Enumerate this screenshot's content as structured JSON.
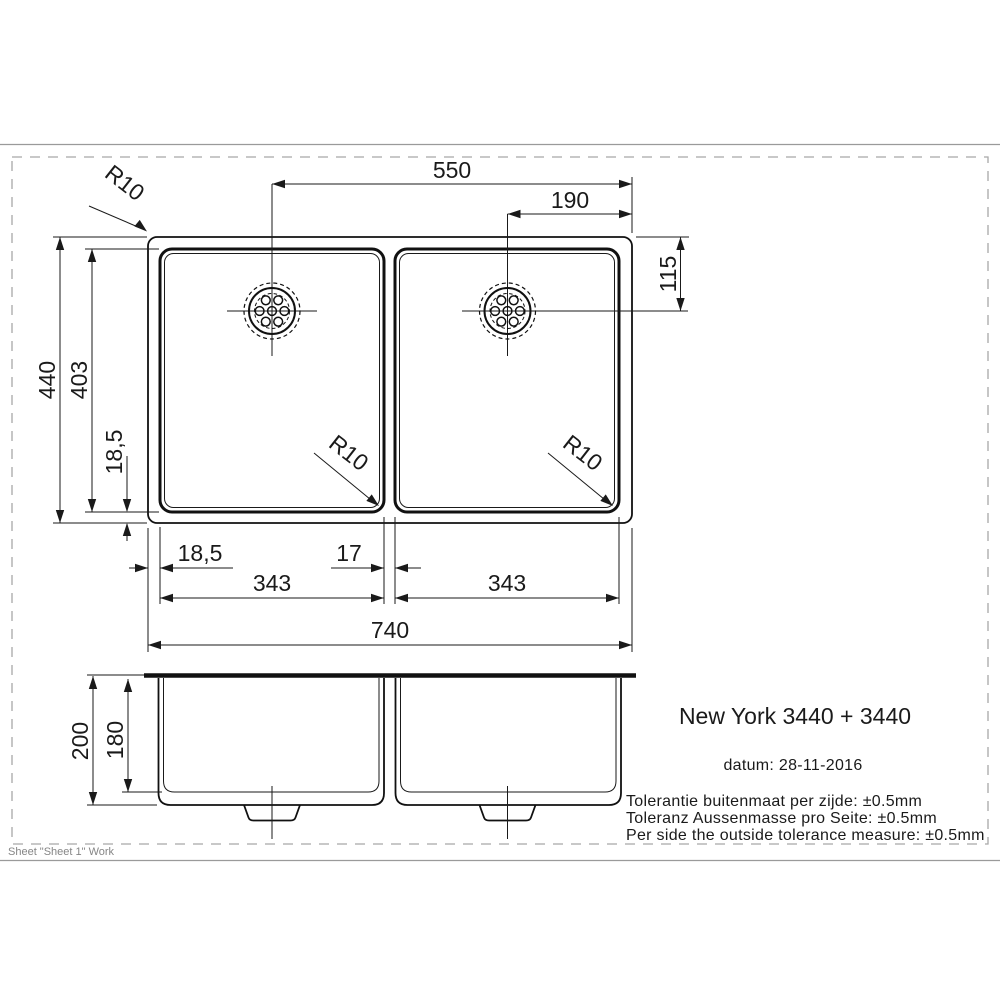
{
  "sheet": {
    "note": "Sheet \"Sheet 1\" Work"
  },
  "product": {
    "title": "New York 3440 + 3440",
    "date_label": "datum: 28-11-2016",
    "tolerances": {
      "nl": "Tolerantie buitenmaat per zijde: ±0.5mm",
      "de": "Toleranz Aussenmasse pro Seite: ±0.5mm",
      "en": "Per side the outside tolerance measure: ±0.5mm"
    }
  },
  "top_view": {
    "dimensions": {
      "drain_to_right_edge": "550",
      "right_drain_to_right_edge": "190",
      "right_drain_from_top": "115",
      "outer_depth": "440",
      "bowl_depth": "403",
      "bowl_bottom_inset": "18,5",
      "bowl_left_inset": "18,5",
      "center_divider": "17",
      "left_bowl_width": "343",
      "right_bowl_width": "343",
      "outer_width": "740"
    },
    "radii": {
      "outer_corner": "R10",
      "left_bowl_corner": "R10",
      "right_bowl_corner": "R10"
    }
  },
  "front_view": {
    "dimensions": {
      "overall_depth": "200",
      "inner_depth": "180"
    }
  }
}
